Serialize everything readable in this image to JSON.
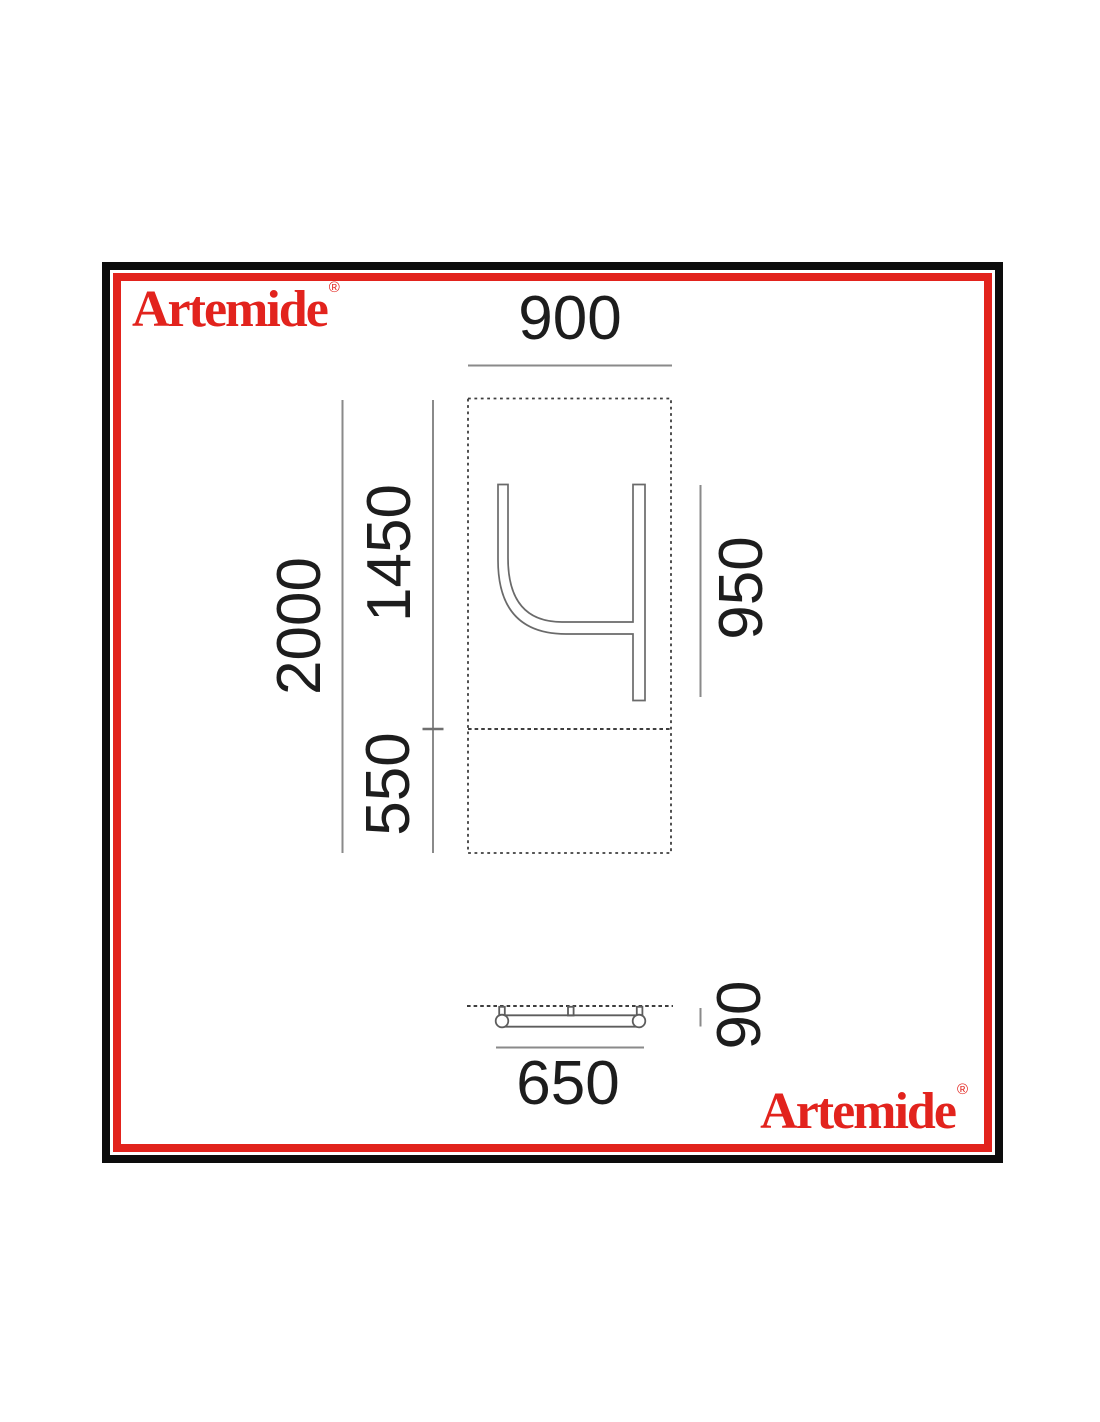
{
  "branding": {
    "color": "#e2231d",
    "top_left": {
      "text": "Artemide",
      "mark": "®"
    },
    "bottom_right": {
      "text": "Artemide",
      "mark": "®"
    }
  },
  "frame": {
    "outer_color": "#0c0c0c",
    "inner_color": "#e2231d"
  },
  "drawing": {
    "type": "technical-dimension-diagram",
    "subject": "wall-mounted lamp, front view and bottom view",
    "line_color": "#8a8a8a",
    "dash_color": "#3e3e3e",
    "front_view": {
      "width": "900",
      "total_height": "2000",
      "upper_height": "1450",
      "lower_height": "550",
      "right_height": "950"
    },
    "side_view": {
      "width": "650",
      "depth": "90"
    }
  }
}
